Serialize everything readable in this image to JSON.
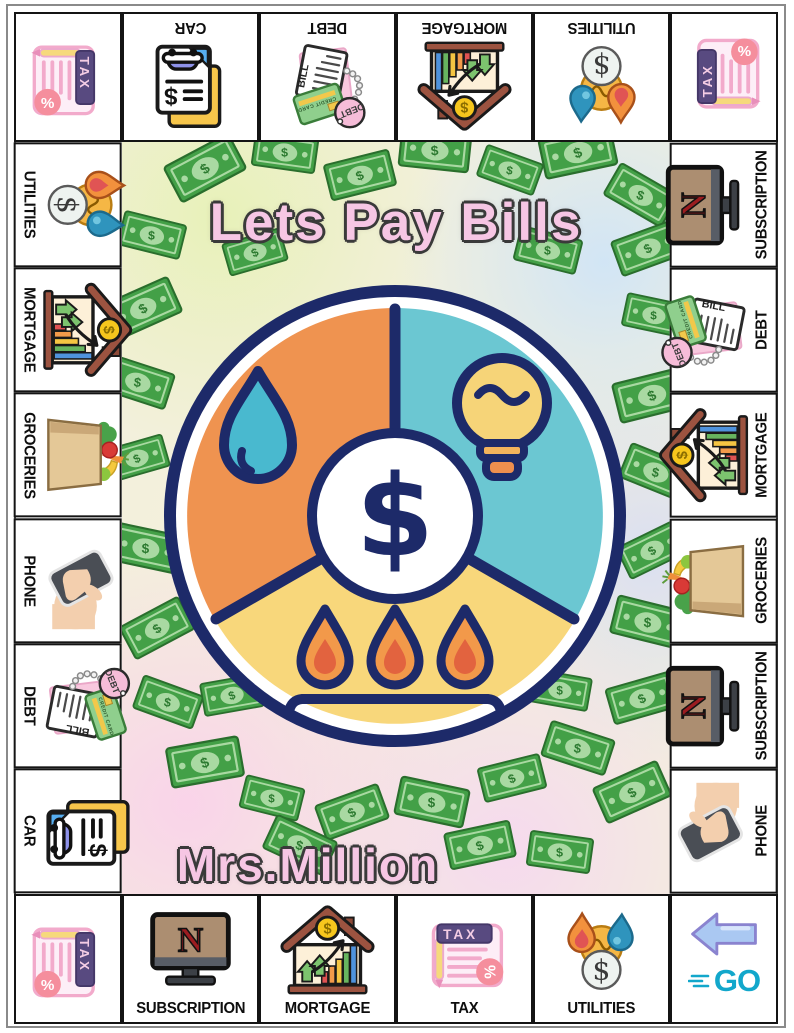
{
  "title": "Lets Pay Bills",
  "author": "Mrs.Million",
  "icon_text": {
    "tax": "TAX",
    "bill": "BILL",
    "credit_card": "CREDIT CARD",
    "debt": "DEBT",
    "netflix": "N",
    "go": "GO",
    "dollar": "$",
    "percent": "%"
  },
  "board": {
    "corners": {
      "top_left": {
        "icon": "tax"
      },
      "top_right": {
        "icon": "tax"
      },
      "bottom_left": {
        "icon": "tax"
      },
      "bottom_right": {
        "icon": "go",
        "label": "GO"
      }
    },
    "top": [
      {
        "label": "CAR",
        "icon": "car"
      },
      {
        "label": "DEBT",
        "icon": "debt"
      },
      {
        "label": "MORTGAGE",
        "icon": "mortgage"
      },
      {
        "label": "UTILITIES",
        "icon": "utilities"
      }
    ],
    "left": [
      {
        "label": "UTILITIES",
        "icon": "utilities"
      },
      {
        "label": "MORTGAGE",
        "icon": "mortgage"
      },
      {
        "label": "GROCERIES",
        "icon": "groceries"
      },
      {
        "label": "PHONE",
        "icon": "phone"
      },
      {
        "label": "DEBT",
        "icon": "debt"
      },
      {
        "label": "CAR",
        "icon": "car"
      }
    ],
    "right": [
      {
        "label": "SUBSCRIPTION",
        "icon": "subscription"
      },
      {
        "label": "DEBT",
        "icon": "debt"
      },
      {
        "label": "MORTGAGE",
        "icon": "mortgage"
      },
      {
        "label": "GROCERIES",
        "icon": "groceries"
      },
      {
        "label": "SUBSCRIPTION",
        "icon": "subscription"
      },
      {
        "label": "PHONE",
        "icon": "phone"
      }
    ],
    "bottom": [
      {
        "label": "SUBSCRIPTION",
        "icon": "subscription"
      },
      {
        "label": "MORTGAGE",
        "icon": "mortgage"
      },
      {
        "label": "TAX",
        "icon": "tax",
        "irot": -90
      },
      {
        "label": "UTILITIES",
        "icon": "utilities"
      }
    ]
  },
  "wheel": {
    "center_symbol": "$",
    "segments": [
      {
        "name": "water",
        "color": "#ef9350"
      },
      {
        "name": "electricity",
        "color": "#6bc7d2"
      },
      {
        "name": "gas",
        "color": "#f8d77b"
      }
    ],
    "outline_color": "#1d2a69"
  },
  "colors": {
    "money_green": "#43a047",
    "money_light": "#a9d9a2",
    "title_pink": "#f6c6e4",
    "board_line": "#141414",
    "go_teal": "#12a7cb",
    "go_arrow_blue": "#aac8f2"
  }
}
